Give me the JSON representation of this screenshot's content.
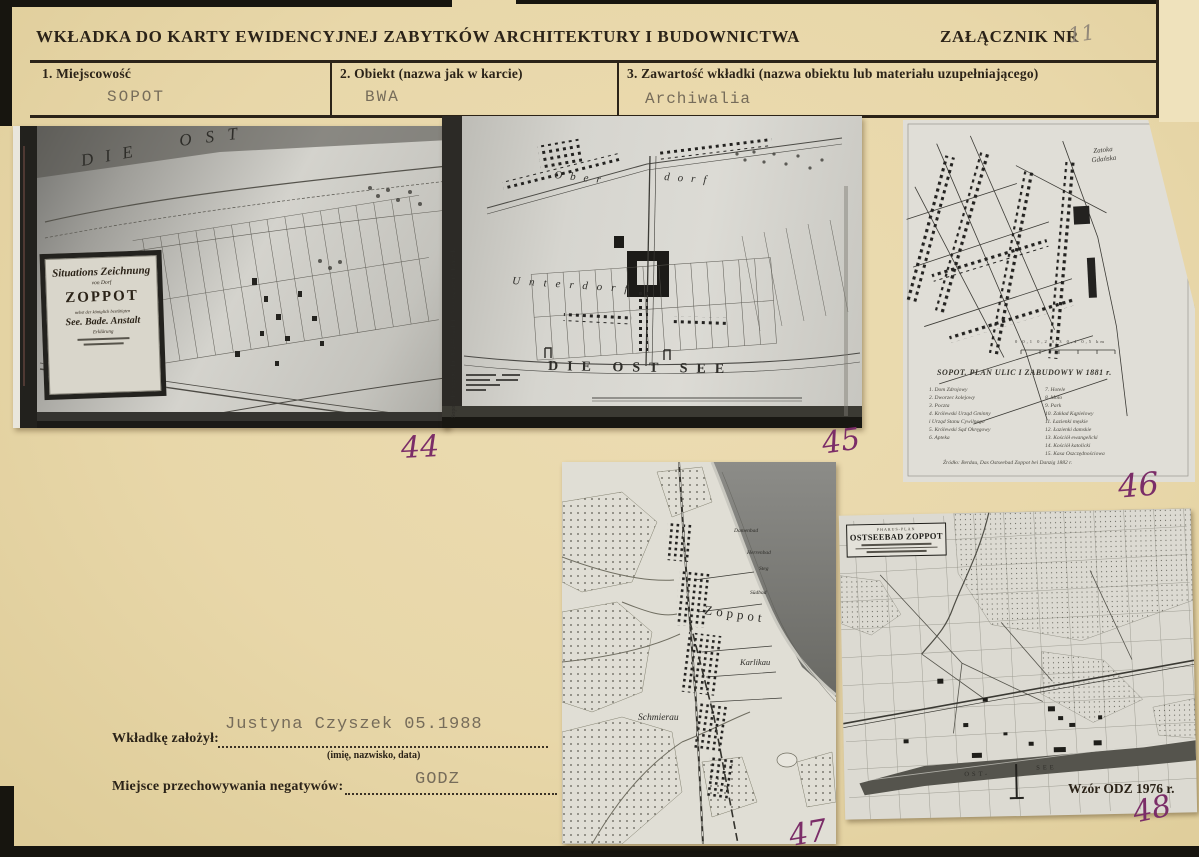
{
  "header": {
    "title": "WKŁADKA DO KARTY EWIDENCYJNEJ ZABYTKÓW ARCHITEKTURY I BUDOWNICTWA",
    "attachment_label": "ZAŁĄCZNIK NR",
    "attachment_number": "11"
  },
  "form": {
    "field1_label": "1.  Miejscowość",
    "field1_value": "SOPOT",
    "field2_label": "2.  Obiekt (nazwa jak w karcie)",
    "field2_value": "BWA",
    "field3_label": "3.  Zawartość wkładki (nazwa obiektu lub materiału uzupełniającego)",
    "field3_value": "Archiwalia"
  },
  "photos": {
    "p44": {
      "number": "44",
      "sea_word1": "DIE",
      "sea_word2": "OST",
      "cartouche_line1": "Situations Zeichnung",
      "cartouche_line2": "von Dorf",
      "cartouche_line3": "ZOPPOT",
      "cartouche_line4": "nebst der königlich bestätigten",
      "cartouche_line5": "See. Bade. Anstalt",
      "cartouche_line6": "Erklärung"
    },
    "p45": {
      "number": "45",
      "caption_left": "Sopot, Plan Sopotu z lat 1842-44, skala 1 : 5000, wg kopii F. Kamiński",
      "label_ober": "Ober",
      "label_dorf": "dorf",
      "label_unterdorf": "Unterdorf",
      "sea_label": "DIE OST SEE"
    },
    "p46": {
      "number": "46",
      "bay_label": "Zatoka\nGdańska",
      "scale_labels": "0   0,1   0,2   0,3   0,4   0,5 km",
      "caption": "SOPOT. PLAN ULIC I ZABUDOWY W 1881 r.",
      "legend_left": "1. Dom Zdrojowy\n2. Dworzec kolejowy\n3. Poczta\n4. Królewski Urząd Gminny\n    i Urząd Stanu Cywilnego\n5. Królewski Sąd Okręgowy\n6. Apteka",
      "legend_right": "7. Hotele\n8. Molo\n9. Park\n10. Zakład Kąpielowy\n11. Łazienki męskie\n12. Łazienki damskie\n13. Kościół ewangelicki\n14. Kościół katolicki\n15. Kasa Oszczędnościowa",
      "source": "Źródło: Berdau, Das Ostseebad Zoppot bei Danzig 1882 r."
    },
    "p47": {
      "number": "47",
      "town_label": "Zoppot",
      "label_schmierau": "Schmierau",
      "label_karlikau": "Karlikau",
      "label_damenbad": "Damenbad",
      "label_herrenbad": "Herrenbad",
      "label_steg": "Steg",
      "label_suedbad": "Südbad"
    },
    "p48": {
      "number": "48",
      "plan_brand": "PHARUS-PLAN",
      "plan_title": "OSTSEEBAD ZOPPOT",
      "sea_word1": "OST-",
      "sea_word2": "SEE"
    }
  },
  "footer": {
    "founder_label": "Wkładkę  założył:",
    "founder_value": "Justyna Czyszek 05.1988",
    "founder_hint": "(imię, nazwisko, data)",
    "storage_label": "Miejsce  przechowywania  negatywów:",
    "storage_value": "GODZ",
    "template_note": "Wzór ODZ 1976 r."
  },
  "colors": {
    "paper": "#e8d7a9",
    "ink": "#2b2318",
    "typewriter": "#766c5a",
    "annotation": "#7b2d68"
  }
}
